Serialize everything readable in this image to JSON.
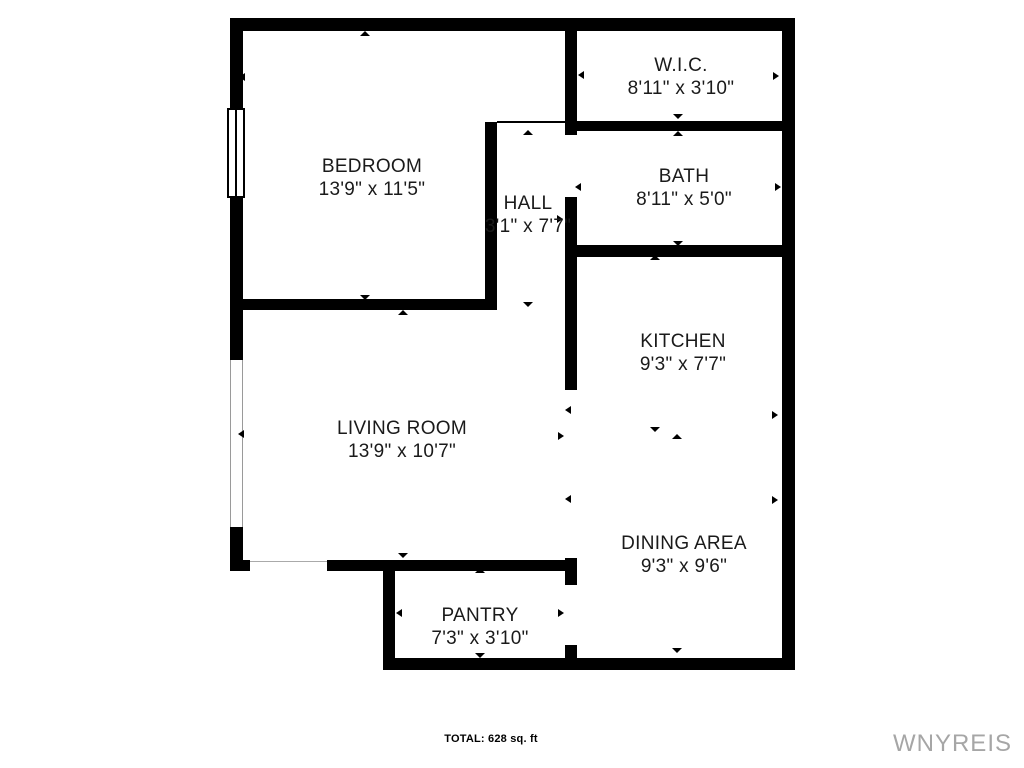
{
  "document": {
    "type": "floor-plan",
    "total_area_label": "TOTAL: 628 sq. ft",
    "watermark": "WNYREIS"
  },
  "rooms": [
    {
      "name": "BEDROOM",
      "dims": "13'9\" x 11'5\""
    },
    {
      "name": "W.I.C.",
      "dims": "8'11\" x 3'10\""
    },
    {
      "name": "HALL",
      "dims": "3'1\" x 7'7\""
    },
    {
      "name": "BATH",
      "dims": "8'11\" x 5'0\""
    },
    {
      "name": "KITCHEN",
      "dims": "9'3\" x 7'7\""
    },
    {
      "name": "LIVING ROOM",
      "dims": "13'9\" x 10'7\""
    },
    {
      "name": "DINING AREA",
      "dims": "9'3\" x 9'6\""
    },
    {
      "name": "PANTRY",
      "dims": "7'3\" x 3'10\""
    }
  ],
  "colors": {
    "wall": "#000000",
    "background": "#ffffff",
    "text": "#1a1a1a",
    "watermark": "#a6a6a6"
  }
}
